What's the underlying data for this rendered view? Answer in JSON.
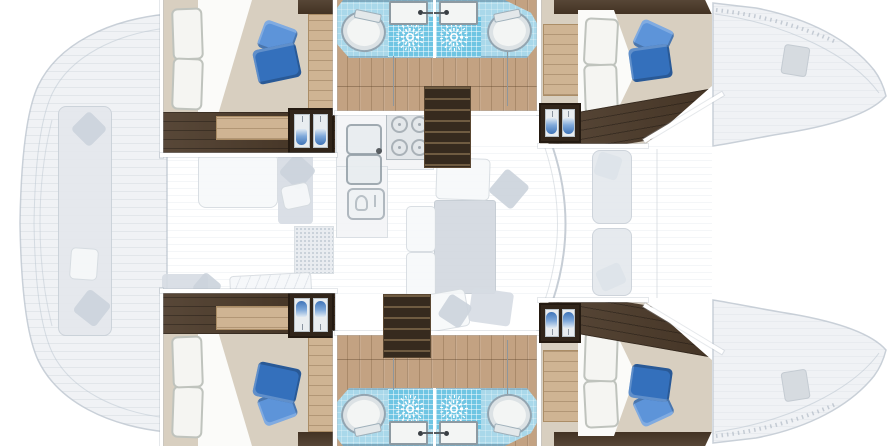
{
  "meta": {
    "type": "boat-floor-plan",
    "subject": "catamaran interior layout, top view, hull accommodations highlighted",
    "canvas": {
      "width": 890,
      "height": 446
    }
  },
  "legend": {
    "solid_rendered": "lower-deck hull interiors: cabins, bathrooms, wardrobes, companionway stairs",
    "ghosted_rendered": "main-deck areas: aft cockpit, salon, galley, windshield, foredeck and bows"
  },
  "areas": {
    "aft_cockpit": {
      "items": [
        "bench-seat",
        "seat-cushions",
        "transom-steps"
      ]
    },
    "salon": {
      "items": [
        "galley-counter",
        "double-sink",
        "stove-4-burner",
        "refrigerator",
        "chart-area",
        "dinette-table",
        "settees",
        "cushions",
        "windshield"
      ]
    },
    "port_hull": {
      "aft_cabin": [
        "double-bed",
        "white-pillows",
        "blue-accent-pillows",
        "folded-sheet",
        "wardrobe",
        "step"
      ],
      "bathrooms": [
        {
          "fixtures": [
            "toilet",
            "shower-with-rose",
            "washbasin"
          ]
        },
        {
          "fixtures": [
            "shower-with-rose",
            "toilet",
            "washbasin"
          ]
        }
      ],
      "companionway": "stairs",
      "forward_cabin": [
        "double-bed",
        "white-pillows",
        "blue-accent-pillows",
        "desk",
        "wardrobe"
      ]
    },
    "starboard_hull": {
      "note": "mirror of port hull",
      "companionway": "stairs"
    },
    "bows": {
      "items": [
        "anchor-locker-hatch",
        "deck-hatch"
      ]
    }
  },
  "colors": {
    "paper": "#ffffff",
    "ghost_fill": "#f0f2f5",
    "ghost_line": "#c9d0d8",
    "ghost_seat": "#e4e8ed",
    "ghost_seat_dark": "#d6dce3",
    "ghost_pillow": "#cbd3dc",
    "wood_floor": "#c3a282",
    "wood_step": "#cfb493",
    "dark_wood": "#4a3827",
    "dark_wood_deep": "#31251a",
    "bed_beige": "#d8cfc0",
    "sheet_white": "#fbfbf9",
    "pillow_white": "#f5f5f2",
    "pillow_line": "#bfc3bd",
    "blue_pillow": "#3470bc",
    "blue_pillow_light": "#5d94d9",
    "bath_blue": "#a9d8ea",
    "shower_blue": "#6fc5e3",
    "tile_line": "rgba(255,255,255,0.5)",
    "porcelain": "#f3f5f4",
    "porcelain_line": "#93a5b1",
    "stair_wood": "#362a1e",
    "stair_tread": "#6f5b41",
    "wall": "#ffffff",
    "hull_outline": "#c2c9d0"
  }
}
